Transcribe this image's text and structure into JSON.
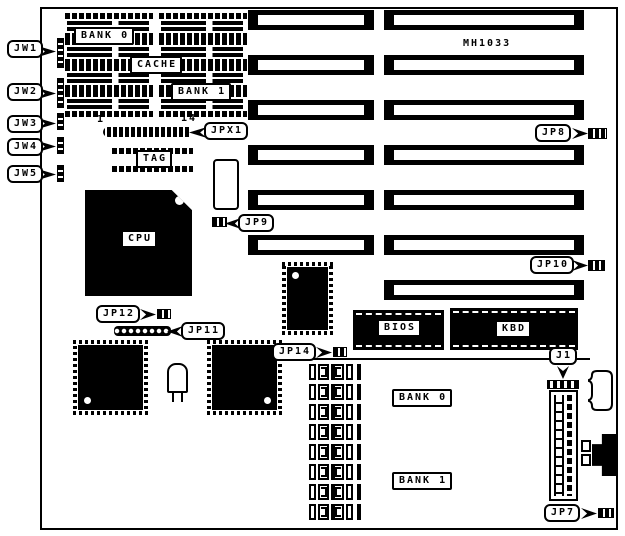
{
  "board": {
    "model_label": "MH1033"
  },
  "labels": {
    "jw1": "JW1",
    "jw2": "JW2",
    "jw3": "JW3",
    "jw4": "JW4",
    "jw5": "JW5",
    "jpx1": "JPX1",
    "jpx1_pin_first": "1",
    "jpx1_pin_last": "14",
    "jp8": "JP8",
    "jp9": "JP9",
    "jp10": "JP10",
    "jp11": "JP11",
    "jp12": "JP12",
    "jp14": "JP14",
    "j1": "J1",
    "jp7": "JP7"
  },
  "chips": {
    "cache_bank0": "BANK 0",
    "cache": "CACHE",
    "cache_bank1": "BANK 1",
    "tag": "TAG",
    "cpu": "CPU",
    "bios": "BIOS",
    "kbd": "KBD"
  },
  "memory": {
    "bank0": "BANK 0",
    "bank1": "BANK 1",
    "socket_count": 8
  },
  "slots": {
    "left_count": 6,
    "right_count": 7
  },
  "cache_chips": {
    "per_column": 4,
    "columns": 2
  },
  "colors": {
    "ink": "#000000",
    "paper": "#ffffff"
  }
}
